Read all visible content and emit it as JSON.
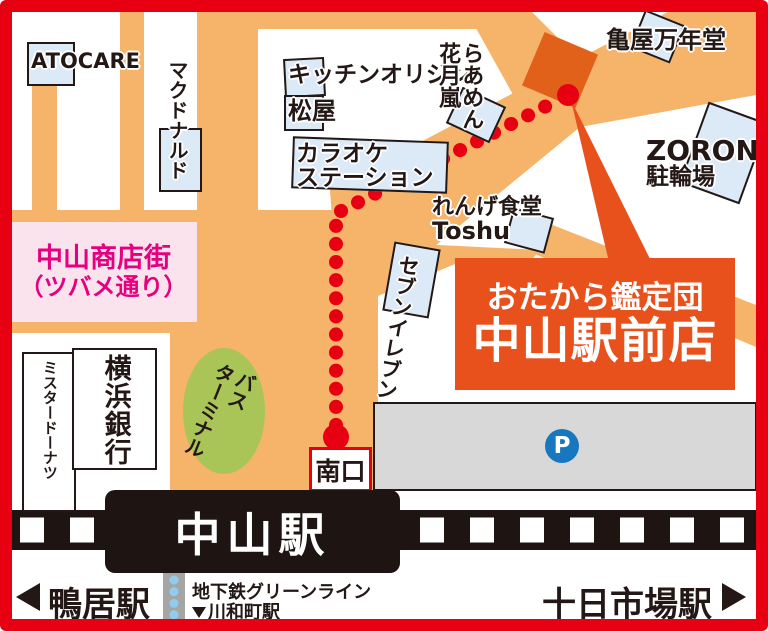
{
  "palette": {
    "border_red": "#E60012",
    "road_orange": "#F5B469",
    "route_red": "#E60012",
    "callout_orange": "#E8511C",
    "building_orange": "#E2611A",
    "label_blue": "#DCE9F6",
    "ink_black": "#231815",
    "pink_bg": "#FAE3ED",
    "pink_text": "#E5007F",
    "bus_green": "#A9C557",
    "parking_gray": "#D8D8D9",
    "subway_gray": "#A5A5A5",
    "subway_dot_blue": "#8FCDEE",
    "parking_icon_blue": "#1778C0"
  },
  "callout": {
    "line1": "おたから鑑定団",
    "line2": "中山駅前店"
  },
  "landmarks": {
    "atocare": "ATOCARE",
    "mcdonalds": "マクドナルド",
    "kitchen_origin": "キッチンオリジン",
    "matsuya": "松屋",
    "karaoke_line1": "カラオケ",
    "karaoke_line2": "ステーション",
    "ramen_col1": "らあめん",
    "ramen_col2": "花月嵐",
    "kameya": "亀屋万年堂",
    "zoron_line1": "ZORON",
    "zoron_line2": "駐輪場",
    "renge_line1": "れんげ食堂",
    "renge_line2": "Toshu",
    "seven_eleven": "セブンイレブン",
    "shopping_street_line1": "中山商店街",
    "shopping_street_line2": "（ツバメ通り）",
    "mister_donut": "ミスタードーナツ",
    "yokohama_bank": "横浜銀行",
    "bus_terminal_col1": "バス",
    "bus_terminal_col2": "ターミナル"
  },
  "station": {
    "name": "中山駅",
    "south_exit": "南口",
    "parking_mark": "P"
  },
  "footer": {
    "left_station": "鴨居駅",
    "subway_line": "地下鉄グリーンライン",
    "subway_next": "川和町駅",
    "right_station": "十日市場駅"
  }
}
